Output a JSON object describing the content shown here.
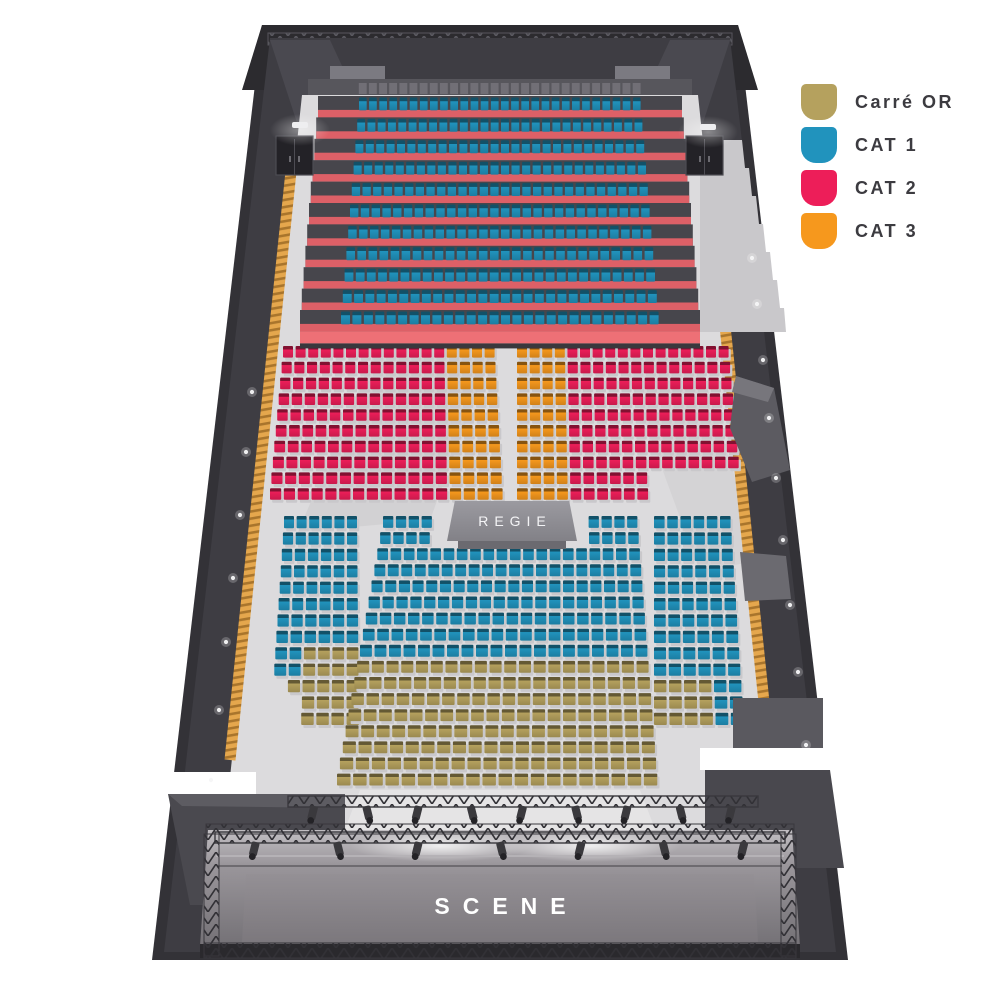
{
  "legend": {
    "items": [
      {
        "id": "cor",
        "label": "Carré OR",
        "color": "#b5a15e"
      },
      {
        "id": "c1",
        "label": "CAT 1",
        "color": "#2193bd"
      },
      {
        "id": "c2",
        "label": "CAT 2",
        "color": "#ed1e59"
      },
      {
        "id": "c3",
        "label": "CAT 3",
        "color": "#f6981d"
      }
    ]
  },
  "labels": {
    "regie": "REGIE",
    "scene": "SCENE"
  },
  "venue": {
    "wall_color": "#343338",
    "floor_color": "#dcdbdd",
    "riser_color": "#dd6067",
    "riser_bottom_color": "#ee7076",
    "platform_color": "#47464c",
    "backrest_color": "#716f76",
    "pad_color": "#c9c8cb"
  },
  "seating": {
    "tribune": {
      "name": "tribune-cat1",
      "x": 318,
      "y": 96,
      "w": 364,
      "rows": 11,
      "ch": 21.4,
      "seatCols": 28,
      "inset": 40,
      "spread": 18,
      "cat": "c1"
    },
    "blocks": [
      {
        "name": "mid-left-cat2",
        "x": 283,
        "y": 346,
        "cols": 17,
        "rows": 10,
        "cw": 12.6,
        "ch": 15.8,
        "spreadL": 13,
        "spreadR": 8,
        "segments": [
          {
            "r0": 0,
            "r1": 9,
            "c0": 0,
            "c1": 12,
            "cat": "c2"
          },
          {
            "r0": 0,
            "r1": 9,
            "c0": 13,
            "c1": 16,
            "cat": "c3"
          }
        ]
      },
      {
        "name": "mid-right-cat2",
        "x": 517,
        "y": 346,
        "cols": 17,
        "rows": 10,
        "cw": 12.6,
        "ch": 15.8,
        "spreadL": 0,
        "spreadR": 13,
        "segments": [
          {
            "r0": 0,
            "r1": 9,
            "c0": 0,
            "c1": 3,
            "cat": "c3"
          },
          {
            "r0": 0,
            "r1": 7,
            "c0": 4,
            "c1": 16,
            "cat": "c2"
          },
          {
            "r0": 8,
            "r1": 9,
            "c0": 4,
            "c1": 9,
            "cat": "c2"
          }
        ]
      },
      {
        "name": "low-left-cat1",
        "x": 284,
        "y": 516,
        "cols": 6,
        "rows": 13,
        "cw": 12.6,
        "ch": 16.4,
        "spreadL": 13,
        "spreadR": 2,
        "segments": [
          {
            "r0": 0,
            "r1": 7,
            "c0": 0,
            "c1": 5,
            "cat": "c1"
          },
          {
            "r0": 8,
            "r1": 9,
            "c0": 0,
            "c1": 1,
            "cat": "c1"
          },
          {
            "r0": 8,
            "r1": 9,
            "c0": 2,
            "c1": 5,
            "cat": "cor"
          },
          {
            "r0": 10,
            "r1": 10,
            "c0": 1,
            "c1": 5,
            "cat": "cor"
          },
          {
            "r0": 11,
            "r1": 12,
            "c0": 2,
            "c1": 5,
            "cat": "cor"
          }
        ]
      },
      {
        "name": "low-center",
        "x": 383,
        "y": 516,
        "cols": 20,
        "rows": 17,
        "cw": 12.85,
        "ch": 16.1,
        "spreadL": 46,
        "spreadR": 20,
        "segments": [
          {
            "r0": 0,
            "r1": 1,
            "c0": 0,
            "c1": 3,
            "cat": "c1"
          },
          {
            "r0": 0,
            "r1": 1,
            "c0": 16,
            "c1": 19,
            "cat": "c1"
          },
          {
            "r0": 2,
            "r1": 8,
            "c0": 0,
            "c1": 19,
            "cat": "c1"
          },
          {
            "r0": 9,
            "r1": 16,
            "c0": 0,
            "c1": 19,
            "cat": "cor"
          }
        ]
      },
      {
        "name": "low-right-cat1",
        "x": 654,
        "y": 516,
        "cols": 6,
        "rows": 13,
        "cw": 13.2,
        "ch": 16.4,
        "spreadL": 0,
        "spreadR": 13,
        "segments": [
          {
            "r0": 0,
            "r1": 9,
            "c0": 0,
            "c1": 5,
            "cat": "c1"
          },
          {
            "r0": 10,
            "r1": 12,
            "c0": 0,
            "c1": 3,
            "cat": "cor"
          },
          {
            "r0": 10,
            "r1": 12,
            "c0": 4,
            "c1": 5,
            "cat": "c1"
          }
        ]
      }
    ]
  },
  "decor": {
    "trusses": [
      {
        "x": 288,
        "y": 796,
        "w": 470,
        "lights": 9
      },
      {
        "x": 215,
        "y": 832,
        "w": 570,
        "lights": 7
      }
    ],
    "wall_lights": [
      [
        252,
        392
      ],
      [
        246,
        452
      ],
      [
        240,
        515
      ],
      [
        233,
        578
      ],
      [
        226,
        642
      ],
      [
        219,
        710
      ],
      [
        211,
        780
      ],
      [
        752,
        258
      ],
      [
        757,
        304
      ],
      [
        763,
        360
      ],
      [
        769,
        418
      ],
      [
        776,
        478
      ],
      [
        783,
        540
      ],
      [
        790,
        605
      ],
      [
        798,
        672
      ],
      [
        806,
        745
      ]
    ],
    "doors": [
      [
        276,
        136
      ],
      [
        686,
        136
      ]
    ],
    "door_lamps": [
      [
        292,
        122
      ],
      [
        700,
        124
      ]
    ]
  }
}
